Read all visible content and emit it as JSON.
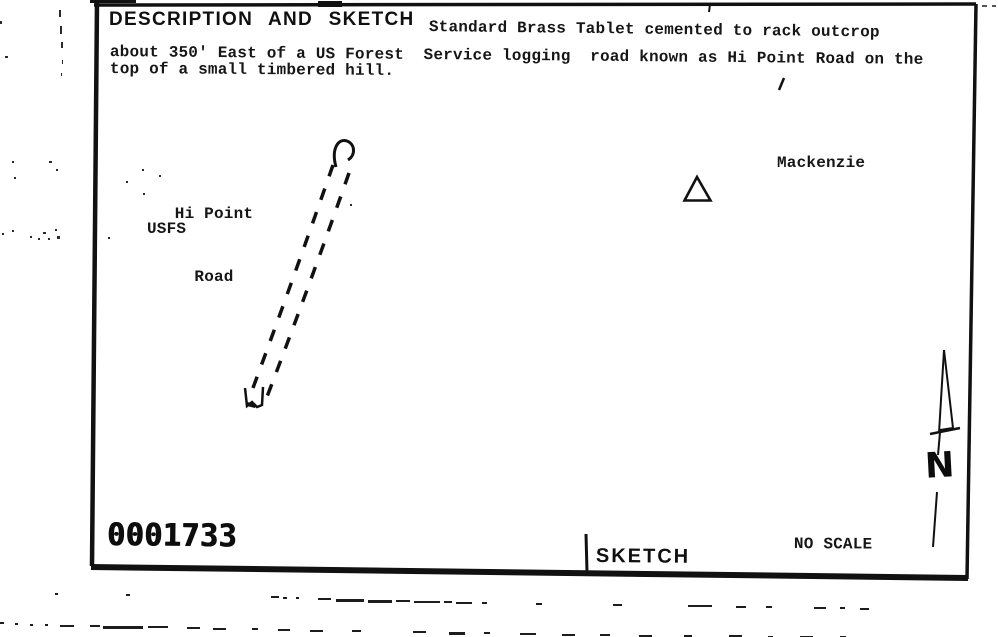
{
  "form": {
    "title": "DESCRIPTION AND SKETCH",
    "description": {
      "line1": "Standard Brass Tablet cemented to rack outcrop",
      "line2": "about 350' East of a US Forest  Service logging  road known as Hi Point Road on the",
      "line3": "top of a small timbered hill."
    },
    "section_label": "SKETCH",
    "scale_note": "NO SCALE",
    "stamp_number": "0001733"
  },
  "sketch": {
    "road_label_line1": "Hi Point",
    "road_label_line2": "Road",
    "agency_label": "USFS",
    "station_label": "Mackenzie",
    "north_letter": "N",
    "symbols": {
      "station_marker": "triangle-station-marker-icon",
      "road": "dashed-double-road-line",
      "north_arrow": "north-arrow-icon"
    }
  },
  "colors": {
    "ink": "#161616",
    "paper": "#ffffff"
  }
}
